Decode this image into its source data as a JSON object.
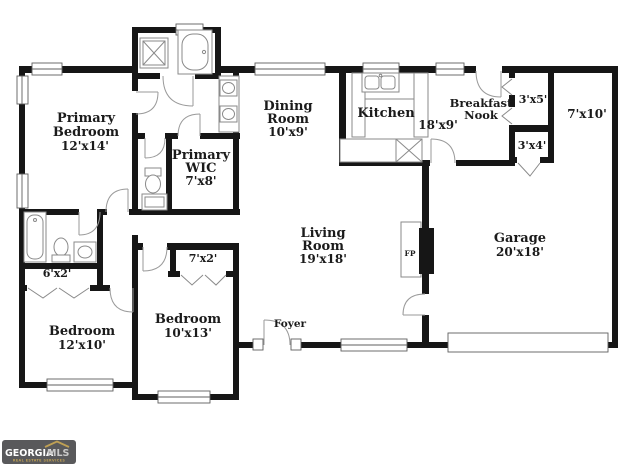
{
  "colors": {
    "background": "#ffffff",
    "wall": "#161616",
    "fixture_line": "#8a8a8a",
    "door_arc": "#9a9a9a",
    "label_text": "#1b1b1b",
    "logo_background": "#59595b",
    "logo_text": "#ffffff",
    "logo_mls": "#c9c9c9",
    "logo_gold": "#bfa054"
  },
  "rooms": {
    "primary_bedroom": {
      "line1": "Primary",
      "line2": "Bedroom",
      "dims": "12'x14'"
    },
    "primary_wic": {
      "line1": "Primary",
      "line2": "WIC",
      "dims": "7'x8'"
    },
    "dining_room": {
      "line1": "Dining",
      "line2": "Room",
      "dims": "10'x9'"
    },
    "kitchen": {
      "name": "Kitchen",
      "dims": "18'x9'"
    },
    "breakfast_nook": {
      "line1": "Breakfast",
      "line2": "Nook"
    },
    "closet_3x5": {
      "dims": "3'x5'"
    },
    "storage_7x10": {
      "dims": "7'x10'"
    },
    "closet_3x4": {
      "dims": "3'x4'"
    },
    "living_room": {
      "line1": "Living",
      "line2": "Room",
      "dims": "19'x18'"
    },
    "fireplace": {
      "label": "FP"
    },
    "garage": {
      "name": "Garage",
      "dims": "20'x18'"
    },
    "foyer": {
      "label": "Foyer"
    },
    "bedroom_12x10": {
      "name": "Bedroom",
      "dims": "12'x10'"
    },
    "bedroom_10x13": {
      "name": "Bedroom",
      "dims": "10'x13'"
    },
    "closet_7x2": {
      "dims": "7'x2'"
    },
    "closet_6x2": {
      "dims": "6'x2'"
    }
  },
  "fixtures": [
    "shower",
    "bathtub",
    "toilet",
    "double-vanity-sinks",
    "hall-bathtub",
    "hall-toilet",
    "hall-sink",
    "kitchen-double-sink",
    "kitchen-range",
    "fireplace",
    "garage-door",
    "windows",
    "door-swings",
    "bifold-closet-doors"
  ],
  "logo": {
    "brand": "GEORGIA",
    "brand_suffix": "MLS",
    "tagline": "REAL ESTATE SERVICES"
  }
}
